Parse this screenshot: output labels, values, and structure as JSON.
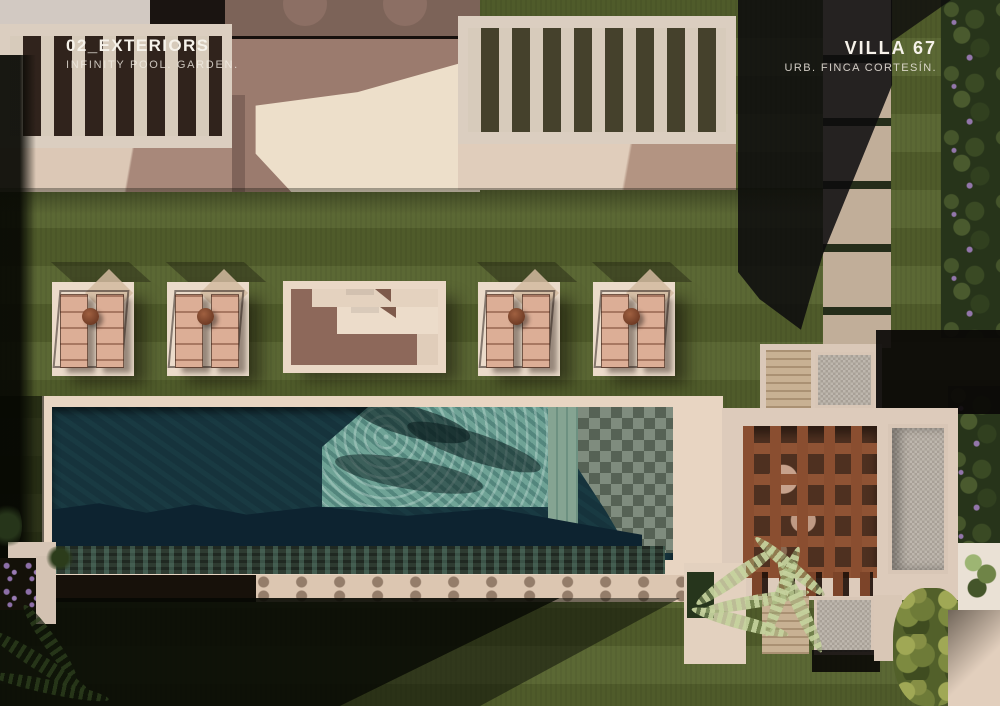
{
  "header": {
    "section": {
      "title": "02_EXTERIORS",
      "subtitle": "INFINITY POOL. GARDEN."
    },
    "project": {
      "title": "VILLA 67",
      "subtitle": "URB. FINCA CORTESÍN."
    }
  },
  "palette": {
    "grass": "#55622d",
    "grass_shadow": "#0a0c04",
    "pool_dark_water": "#16333c",
    "pool_lit_water": "#6fa396",
    "pool_checker_tile": "#6f7d6e",
    "deck_cream": "#e8d5c2",
    "terrace_mauve": "#9b7b6e",
    "pergola_wood": "#8a4e30",
    "gravel": "#b2aba2",
    "travertine": "#c8b193",
    "hedge_green": "#27341a",
    "flower_purple": "#9376ab",
    "stone_path": "#c1ae99",
    "text_white": "#f6f2ea"
  }
}
